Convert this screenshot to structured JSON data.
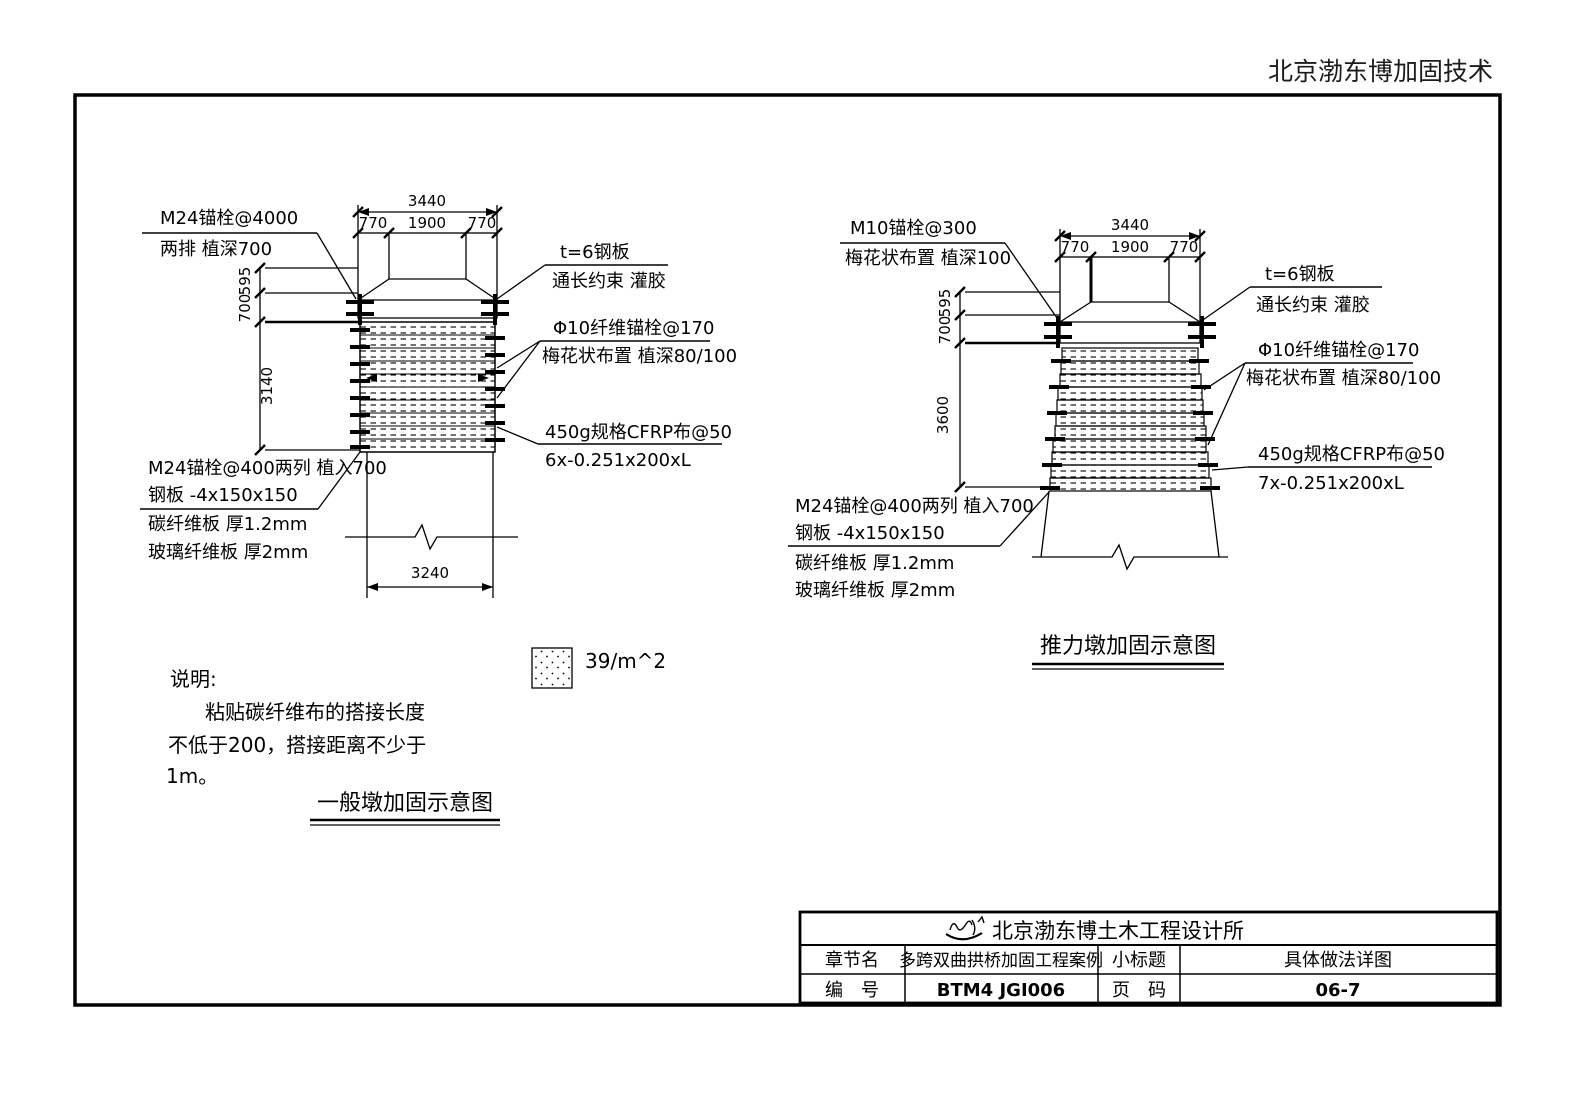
{
  "header": {
    "brand": "北京渤东博加固技术"
  },
  "general_pier": {
    "caption": "一般墩加固示意图",
    "label_anchor_top_line1": "M24锚栓@4000",
    "label_anchor_top_line2": "两排 植深700",
    "label_plate_line1": "t=6钢板",
    "label_plate_line2": "通长约束 灌胶",
    "label_fiber_line1": "Φ10纤维锚栓@170",
    "label_fiber_line2": "梅花状布置 植深80/100",
    "label_cfrp_line1": "450g规格CFRP布@50",
    "label_cfrp_line2": "6x-0.251x200xL",
    "label_anchor_bottom_line1": "M24锚栓@400两列 植入700",
    "label_anchor_bottom_line2": "钢板 -4x150x150",
    "label_cf_plate": "碳纤维板 厚1.2mm",
    "label_gf_plate": "玻璃纤维板 厚2mm",
    "dim_total_top": "3440",
    "dim_left": "770",
    "dim_mid": "1900",
    "dim_right": "770",
    "dim_v1": "595",
    "dim_v2": "700",
    "dim_v3": "3140",
    "dim_bottom": "3240"
  },
  "thrust_pier": {
    "caption": "推力墩加固示意图",
    "label_anchor_top_line1": "M10锚栓@300",
    "label_anchor_top_line2": "梅花状布置 植深100",
    "label_plate_line1": "t=6钢板",
    "label_plate_line2": "通长约束 灌胶",
    "label_fiber_line1": "Φ10纤维锚栓@170",
    "label_fiber_line2": "梅花状布置 植深80/100",
    "label_cfrp_line1": "450g规格CFRP布@50",
    "label_cfrp_line2": "7x-0.251x200xL",
    "label_anchor_bottom_line1": "M24锚栓@400两列 植入700",
    "label_anchor_bottom_line2": "钢板 -4x150x150",
    "label_cf_plate": "碳纤维板 厚1.2mm",
    "label_gf_plate": "玻璃纤维板 厚2mm",
    "dim_total_top": "3440",
    "dim_left": "770",
    "dim_mid": "1900",
    "dim_right": "770",
    "dim_v1": "595",
    "dim_v2": "700",
    "dim_v3": "3600"
  },
  "legend": {
    "swatch_icon": "dot-hatch-swatch",
    "label": "39/m^2"
  },
  "notes": {
    "title": "说明:",
    "line1": "粘贴碳纤维布的搭接长度",
    "line2": "不低于200，搭接距离不少于",
    "line3": "1m。"
  },
  "title_block": {
    "logo_icon": "signature-logo",
    "company": "北京渤东博土木工程设计所",
    "chapter_label": "章节名",
    "chapter_value": "多跨双曲拱桥加固工程案例",
    "subtitle_label": "小标题",
    "subtitle_value": "具体做法详图",
    "number_label": "编　号",
    "number_value": "BTM4 JGI006",
    "page_label": "页　码",
    "page_value": "06-7"
  }
}
